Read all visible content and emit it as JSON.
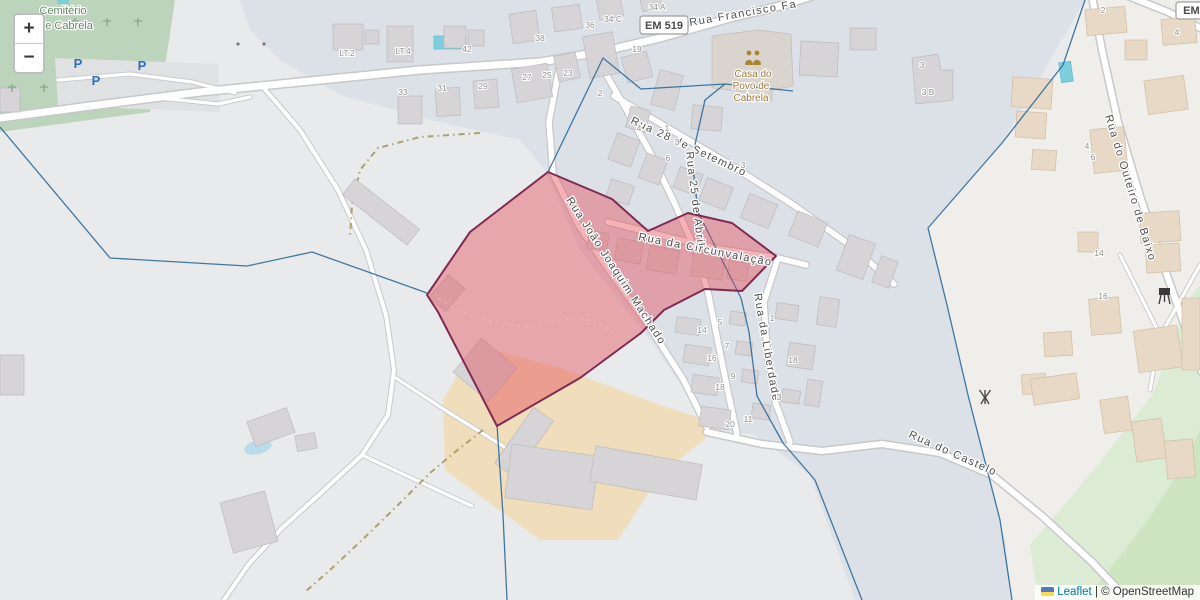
{
  "zoom_control": {
    "zoom_in": "+",
    "zoom_out": "−"
  },
  "attribution": {
    "leaflet": "Leaflet",
    "separator": "|",
    "copyright": "© OpenStreetMap"
  },
  "road_shields": [
    {
      "label": "EM 519"
    },
    {
      "label": "EM 5"
    }
  ],
  "street_labels": [
    {
      "name": "Rua Francisco Fa"
    },
    {
      "name": "Rua 28 de Setembro"
    },
    {
      "name": "Rua 25 de Abril"
    },
    {
      "name": "Rua da Circunvalação"
    },
    {
      "name": "Rua João Joaquim Machado"
    },
    {
      "name": "Rua da Liberdade"
    },
    {
      "name": "Rua do Castelo"
    },
    {
      "name": "Rua do Outeiro de Baixo"
    }
  ],
  "place_labels": {
    "cemetery": {
      "line1": "Cemitério",
      "line2": "de Cabrela"
    },
    "community_centre": {
      "line1": "Casa do",
      "line2": "Povo de",
      "line3": "Cabrela"
    }
  },
  "parking_markers": [
    {
      "label": "P"
    },
    {
      "label": "P"
    },
    {
      "label": "P"
    }
  ],
  "house_numbers": [
    {
      "t": "LT.2"
    },
    {
      "t": "LT.4"
    },
    {
      "t": "42"
    },
    {
      "t": "38"
    },
    {
      "t": "36"
    },
    {
      "t": "34 C"
    },
    {
      "t": "34 A"
    },
    {
      "t": "19"
    },
    {
      "t": "27"
    },
    {
      "t": "25"
    },
    {
      "t": "23"
    },
    {
      "t": "33"
    },
    {
      "t": "31"
    },
    {
      "t": "29"
    },
    {
      "t": "2"
    },
    {
      "t": "4"
    },
    {
      "t": "1"
    },
    {
      "t": "3"
    },
    {
      "t": "6"
    },
    {
      "t": "3"
    },
    {
      "t": "14"
    },
    {
      "t": "5"
    },
    {
      "t": "16"
    },
    {
      "t": "7"
    },
    {
      "t": "18"
    },
    {
      "t": "9"
    },
    {
      "t": "20"
    },
    {
      "t": "11"
    },
    {
      "t": "1"
    },
    {
      "t": "18"
    },
    {
      "t": "3"
    },
    {
      "t": "2"
    },
    {
      "t": "4"
    },
    {
      "t": "4"
    },
    {
      "t": "6"
    },
    {
      "t": "14"
    },
    {
      "t": "16"
    },
    {
      "t": "3"
    },
    {
      "t": "3 B"
    }
  ],
  "icons": {
    "community_centre": "two-people-icon",
    "telecom_mast": "antenna-icon",
    "barbecue": "grill-icon",
    "ukraine_flag": "flag-icon"
  },
  "colors": {
    "selection_fill": "#e44854",
    "selection_stroke": "#7d2b52",
    "admin_boundary": "#2d6a99",
    "residential": "#dce1e8",
    "farmyard": "#f0ddbb",
    "cemetery_green": "#bcd4bb",
    "leaflet_link": "#0078a8",
    "parking_blue": "#2e6fba"
  }
}
